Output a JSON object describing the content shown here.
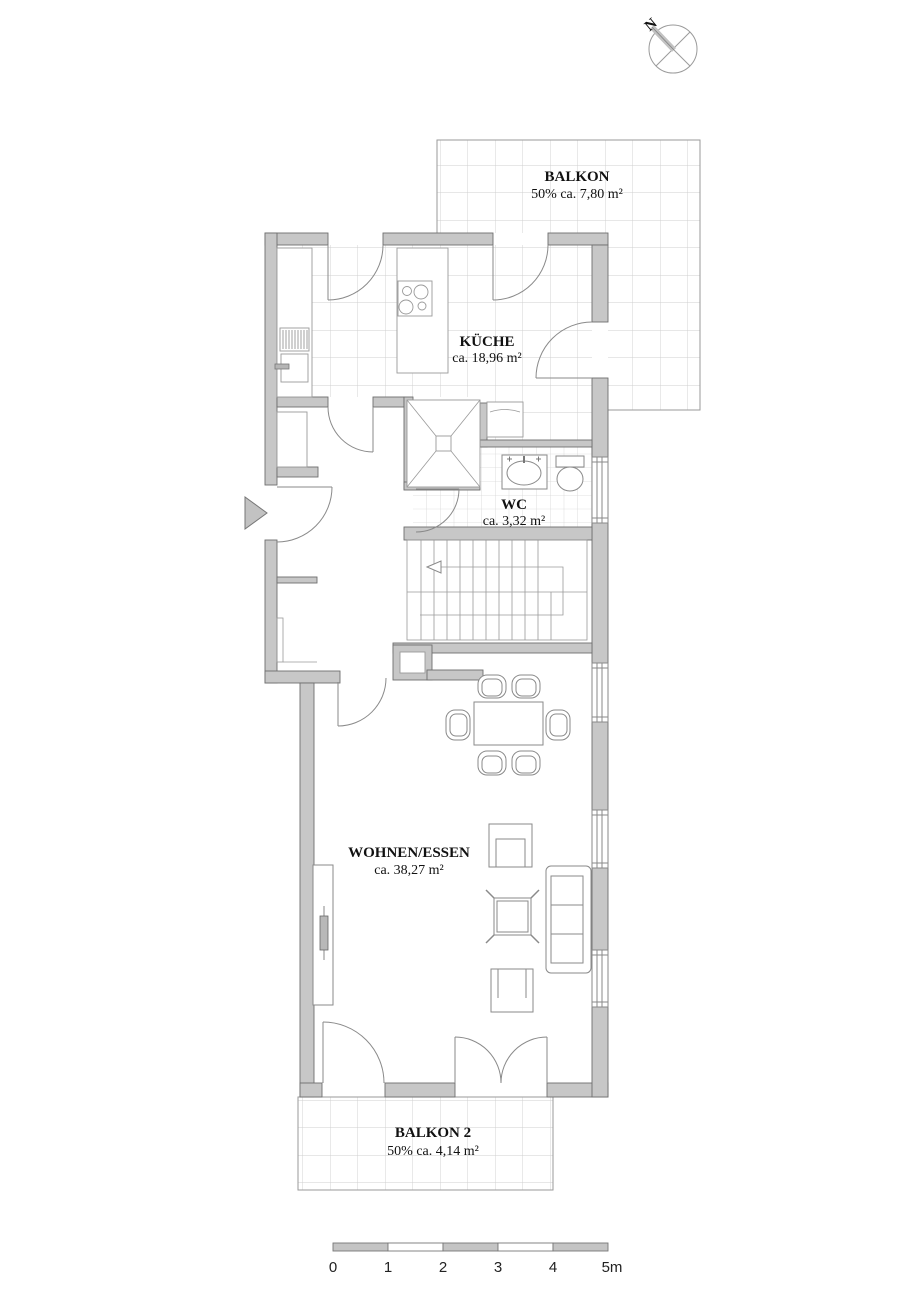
{
  "compass": {
    "north": "N"
  },
  "rooms": {
    "balkon1": {
      "name": "BALKON",
      "area": "50% ca. 7,80 m²"
    },
    "kueche": {
      "name": "KÜCHE",
      "area": "ca. 18,96 m²"
    },
    "wc": {
      "name": "WC",
      "area": "ca. 3,32 m²"
    },
    "wohnen_essen": {
      "name": "WOHNEN/ESSEN",
      "area": "ca. 38,27 m²"
    },
    "balkon2": {
      "name": "BALKON 2",
      "area": "50% ca. 4,14 m²"
    }
  },
  "scale_bar": {
    "labels": [
      "0",
      "1",
      "2",
      "3",
      "4",
      "5m"
    ]
  },
  "colors": {
    "wall_fill": "#c7c7c7",
    "wall_stroke": "#6e6e6e",
    "line": "#8a8a8a",
    "tile_line": "#cfcfcf",
    "text": "#111111"
  }
}
